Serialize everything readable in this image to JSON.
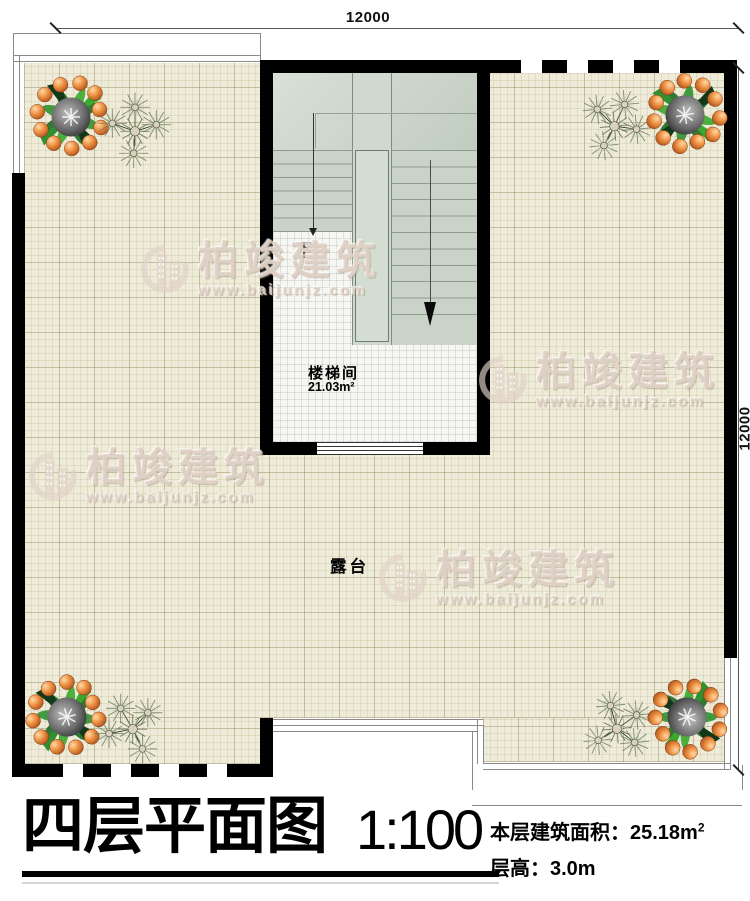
{
  "plan": {
    "dimension_top": "12000",
    "dimension_right": "12000",
    "terrace_label": "露台",
    "stairwell": {
      "name": "楼梯间",
      "area": "21.03m²",
      "down_label": "下"
    }
  },
  "watermark": {
    "brand": "柏竣建筑",
    "url": "www.baijunjz.com"
  },
  "title_block": {
    "title": "四层平面图",
    "scale": "1:100",
    "area_label": "本层建筑面积：",
    "area_value": "25.18m",
    "area_exponent": "2",
    "height_label": "层高：",
    "height_value": "3.0m"
  },
  "colors": {
    "wall": "#000000",
    "tile_base": "#eeebd9",
    "stair_gray": "#c9d3c7",
    "orange_fruit": "#e07a35"
  }
}
